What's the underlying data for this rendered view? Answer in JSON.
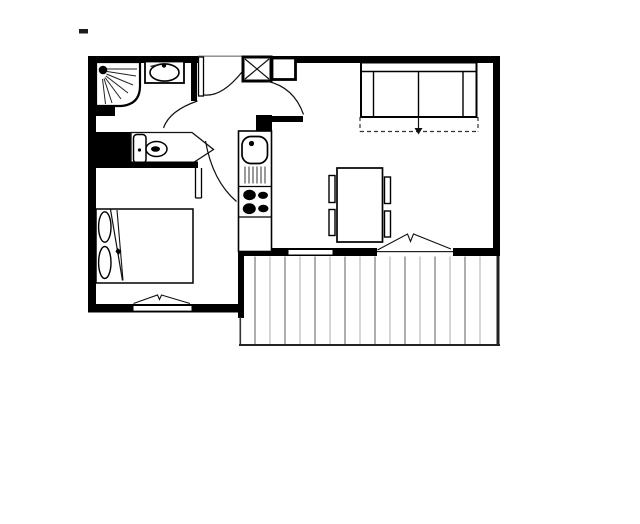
{
  "canvas": {
    "width": 640,
    "height": 524,
    "background": "#ffffff",
    "wall_color": "#000000",
    "line_color": "#111111",
    "deck_line_dark": "#8c8c8c",
    "deck_line_light": "#c4c4c4"
  },
  "floorplan": {
    "type": "apartment-floor-plan",
    "fixture_icons": [
      "shower-icon",
      "washbasin-icon",
      "toilet-icon",
      "entry-door-icon",
      "closet-x-box-icon",
      "wardrobe-box-icon",
      "kitchen-sink-icon",
      "stove-burners-icon",
      "base-cabinet-icon",
      "sofa-bed-icon",
      "sofa-bed-fold-out-arrow-icon",
      "dining-table-icon",
      "chair-icon",
      "double-bed-icon",
      "pillow-icon",
      "casement-window-icon",
      "balcony-door-icon",
      "balcony-decking-icon"
    ]
  }
}
